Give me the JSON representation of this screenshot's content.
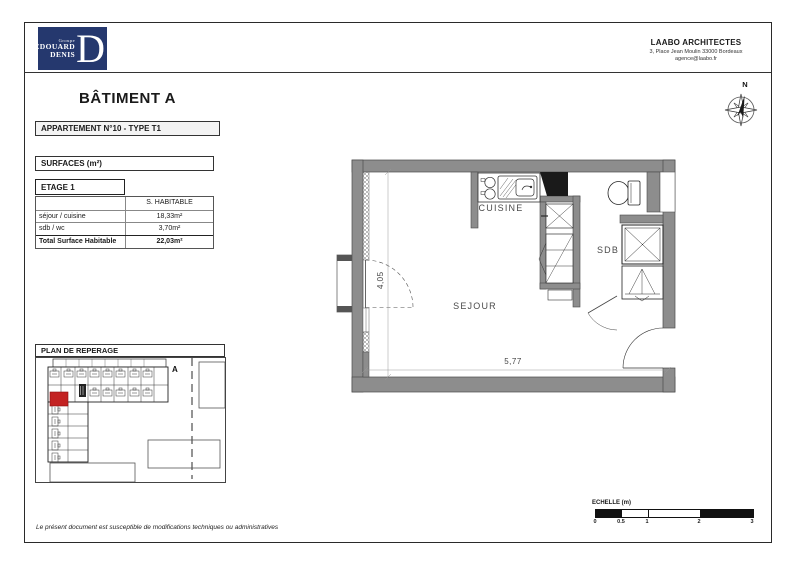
{
  "document": {
    "logo": {
      "groupe": "Groupe",
      "name_line1": "EDOUARD",
      "name_line2": "DENIS",
      "monogram": "D"
    },
    "architect": {
      "name": "LAABO ARCHITECTES",
      "address": "3, Place Jean Moulin  33000 Bordeaux",
      "email": "agence@laabo.fr"
    },
    "compass": {
      "north_label": "N"
    },
    "building_title": "BÂTIMENT A",
    "apartment_title": "APPARTEMENT N°10 - TYPE T1",
    "surfaces": {
      "title": "SURFACES (m²)",
      "floor": "ETAGE 1",
      "col_header": "S. HABITABLE",
      "rows": [
        {
          "label": "séjour / cuisine",
          "value": "18,33m²"
        },
        {
          "label": "sdb / wc",
          "value": "3,70m²"
        }
      ],
      "total_label": "Total Surface Habitable",
      "total_value": "22,03m²"
    },
    "site_plan": {
      "title": "PLAN DE REPERAGE",
      "building_label": "A"
    },
    "floor_plan": {
      "room_kitchen": "CUISINE",
      "room_bathroom": "SDB",
      "room_living": "SEJOUR",
      "dim_height": "4,05",
      "dim_width": "5,77"
    },
    "scale_bar": {
      "title": "ECHELLE (m)",
      "ticks": [
        "0",
        "0.5",
        "1",
        "2",
        "3"
      ]
    },
    "footer_note": "Le présent document est susceptible de modifications techniques ou administratives",
    "colors": {
      "brand_navy": "#25386e",
      "wall_gray": "#8d8d8d",
      "highlight_red": "#c32222"
    }
  }
}
